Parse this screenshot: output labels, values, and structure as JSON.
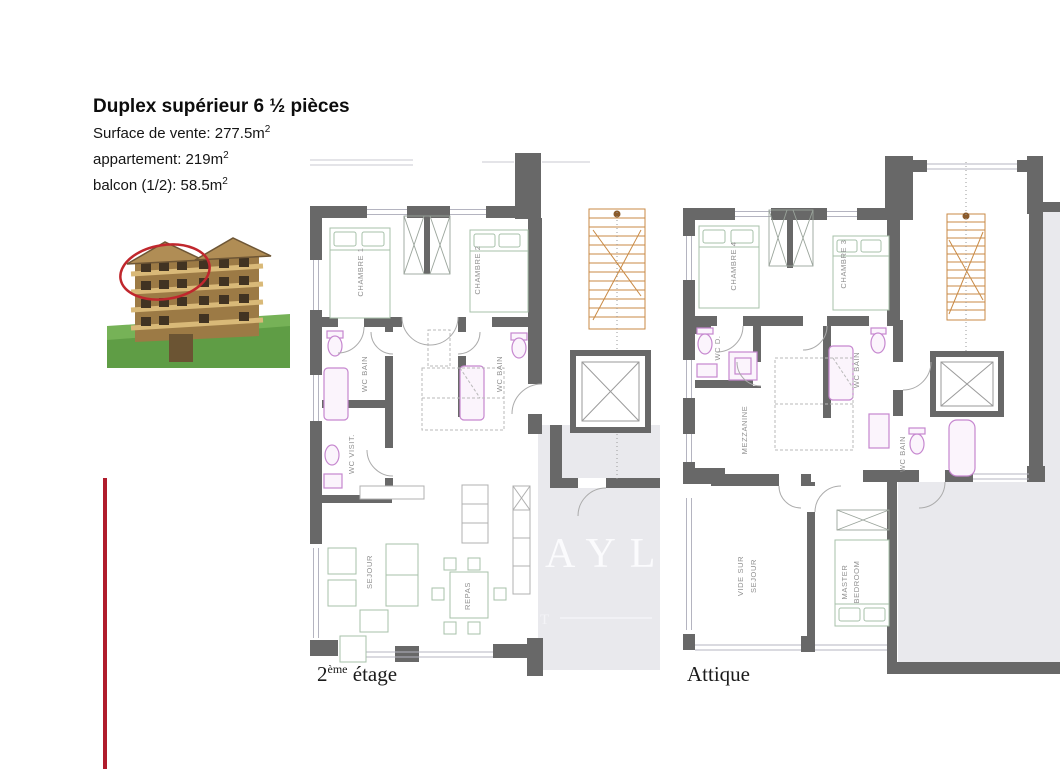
{
  "header": {
    "title": "Duplex supérieur 6 ½ pièces",
    "stats": [
      {
        "text": "Surface de vente: 277.5m",
        "sup": "2"
      },
      {
        "text": "appartement: 219m",
        "sup": "2"
      },
      {
        "text": "balcon (1/2): 58.5m",
        "sup": "2"
      }
    ]
  },
  "planA": {
    "caption_num": "2",
    "caption_sup": "ème",
    "caption_rest": " étage",
    "chambre1": "CHAMBRE 1",
    "chambre2": "CHAMBRE 2",
    "wc_bain_1": "WC BAIN",
    "wc_bain_2": "WC BAIN",
    "wc_visit": "WC VISIT.",
    "sejour": "SEJOUR",
    "repas": "REPAS"
  },
  "planB": {
    "caption": "Attique",
    "chambre4": "CHAMBRE 4",
    "chambre3": "CHAMBRE 3",
    "wc_d": "WC D.",
    "wc_bain_mid": "WC BAIN",
    "wc_bain_right": "WC BAIN",
    "mezzanine": "MEZZANINE",
    "vide_line1": "VIDE SUR",
    "vide_line2": "SEJOUR",
    "master_line1": "MASTER",
    "master_line2": "BEDROOM"
  },
  "watermark": {
    "big": "AYL",
    "small": "T"
  },
  "colors": {
    "wall": "#686868",
    "terrace": "#e9e9ed",
    "fixture_violet": "#c687cf",
    "stairs_orange": "#c98a45",
    "furniture_green": "#a7c0aa",
    "accent_red": "#b01c2c",
    "highlight_ellipse": "#c0272d"
  }
}
